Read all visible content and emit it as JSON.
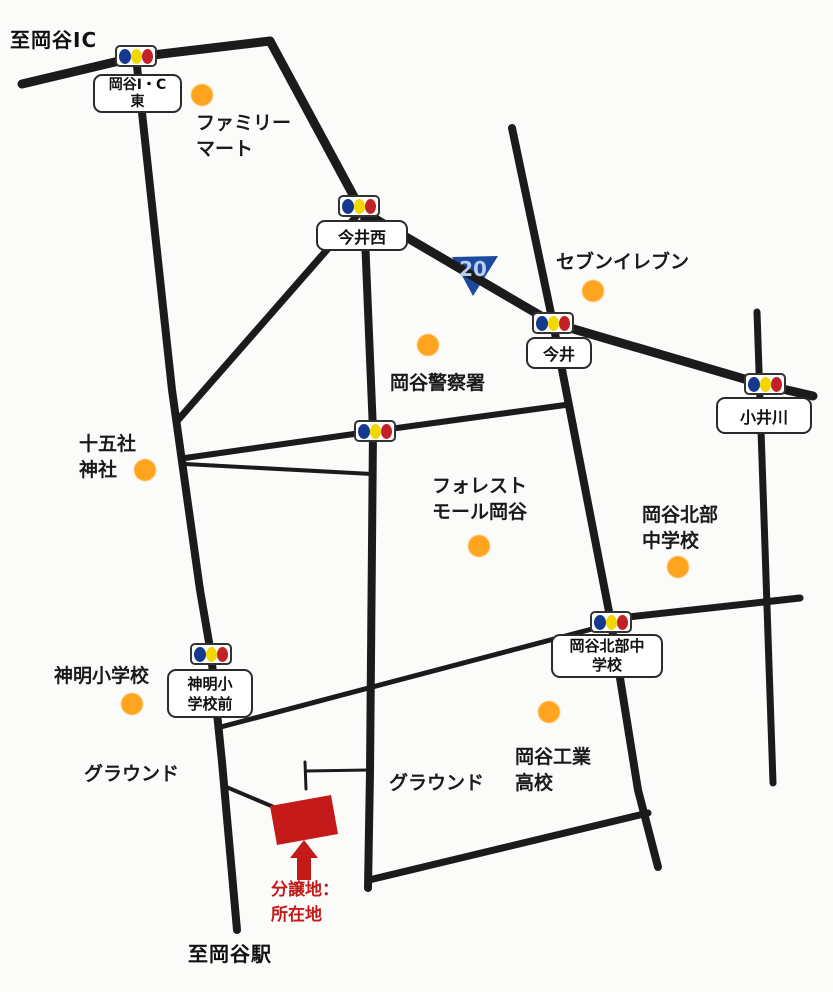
{
  "map_titles": {
    "to_ic": "至岡谷IC",
    "to_station": "至岡谷駅"
  },
  "route_badge": {
    "number": "20",
    "shield_color": "#1d4a9e",
    "text_color": "#b9cdf0"
  },
  "site_marker": {
    "line1": "分譲地：",
    "line2": "所在地",
    "color": "#c41a1a"
  },
  "colors": {
    "road": "#1b1b1b",
    "landmark_dot": "#ffa41e",
    "signal_blue": "#16388f",
    "signal_yellow": "#f0d800",
    "signal_red": "#c32028",
    "background": "#fbfbf9"
  },
  "intersections": [
    {
      "id": "okaya-ic-east",
      "label_lines": [
        "岡谷I・C",
        "東"
      ]
    },
    {
      "id": "imai-nishi",
      "label_lines": [
        "今井西"
      ]
    },
    {
      "id": "imai",
      "label_lines": [
        "今井"
      ]
    },
    {
      "id": "koikawa",
      "label_lines": [
        "小井川"
      ]
    },
    {
      "id": "central-unlabeled",
      "label_lines": []
    },
    {
      "id": "okaya-hokubu-chu",
      "label_lines": [
        "岡谷北部中",
        "学校"
      ]
    },
    {
      "id": "shinmei-sho-mae",
      "label_lines": [
        "神明小",
        "学校前"
      ]
    }
  ],
  "landmarks": [
    {
      "id": "familymart",
      "lines": [
        "ファミリー",
        "マート"
      ],
      "has_dot": true
    },
    {
      "id": "seven-eleven",
      "lines": [
        "セブンイレブン"
      ],
      "has_dot": true
    },
    {
      "id": "okaya-police",
      "lines": [
        "岡谷警察署"
      ],
      "has_dot": true
    },
    {
      "id": "jugosha-shrine",
      "lines": [
        "十五社",
        "神社"
      ],
      "has_dot": true
    },
    {
      "id": "forest-mall-okaya",
      "lines": [
        "フォレスト",
        "モール岡谷"
      ],
      "has_dot": true
    },
    {
      "id": "okaya-hokubu-jhs",
      "lines": [
        "岡谷北部",
        "中学校"
      ],
      "has_dot": true
    },
    {
      "id": "shinmei-elementary",
      "lines": [
        "神明小学校"
      ],
      "has_dot": true
    },
    {
      "id": "okaya-technical-hs",
      "lines": [
        "岡谷工業",
        "高校"
      ],
      "has_dot": true
    },
    {
      "id": "ground-west",
      "lines": [
        "グラウンド"
      ],
      "has_dot": false
    },
    {
      "id": "ground-south",
      "lines": [
        "グラウンド"
      ],
      "has_dot": false
    }
  ]
}
